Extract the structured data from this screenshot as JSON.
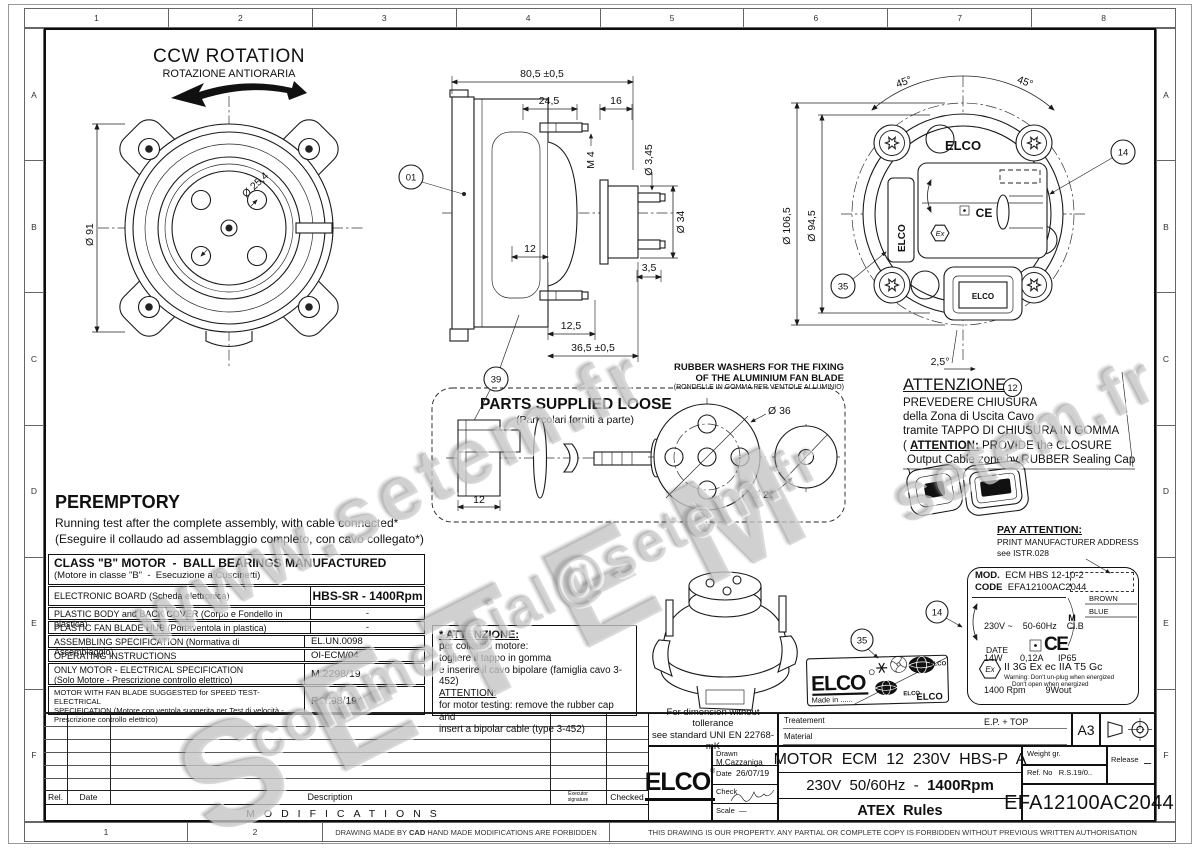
{
  "brand": {
    "name": "ELCO",
    "registered": "®"
  },
  "frame": {
    "cols": [
      "1",
      "2",
      "3",
      "4",
      "5",
      "6",
      "7",
      "8"
    ],
    "rows": [
      "A",
      "B",
      "C",
      "D",
      "E",
      "F"
    ]
  },
  "watermark": {
    "www": "www.setem.fr",
    "setem": "SETEM",
    "email": "commercial@setem.fr",
    "fr": "setem.fr"
  },
  "front_view": {
    "title": "CCW ROTATION",
    "subtitle": "ROTAZIONE ANTIORARIA",
    "dia_body": "Ø 91",
    "dia_shaft": "Ø 25,4"
  },
  "side_view": {
    "len_total": "80,5 ±0,5",
    "len_front": "24,5",
    "len_hub": "16",
    "thread": "M 4",
    "dia_pin": "Ø 3,45",
    "dia_hub": "Ø 34",
    "len_stud": "12",
    "len_pin": "3,5",
    "len_back": "12,5",
    "len_depth": "36,5 ±0,5"
  },
  "rear_view": {
    "dia_outer": "Ø 106,5",
    "dia_bolt": "Ø 94,5",
    "angle_left": "45°",
    "angle_right": "45°",
    "angle_bottom": "2,5°"
  },
  "balloons": {
    "b01": "01",
    "b39": "39",
    "b35": "35",
    "b14": "14",
    "b12": "12"
  },
  "parts_box": {
    "title": "PARTS SUPPLIED LOOSE",
    "subtitle": "(Particolari forniti a parte)",
    "dim_cap": "12",
    "dia_big_washer": "Ø 36",
    "dia_small_washer": "Ø 21",
    "washer_note1": "RUBBER WASHERS FOR THE FIXING",
    "washer_note2": "OF THE ALUMINIUM FAN BLADE",
    "washer_note3": "(RONDELLE IN GOMMA PER VENTOLE ALLUMINIO)"
  },
  "attention_closure": {
    "title": "ATTENZIONE:",
    "line1": "PREVEDERE CHIUSURA",
    "line2": "della Zona di Uscita Cavo",
    "line3": "tramite TAPPO DI CHIUSURA IN GOMMA",
    "line4_pre": "( ",
    "line4_bold": "ATTENTION:",
    "line4_post": " PROVIDE the CLOSURE",
    "line5": "Output Cable zone by RUBBER Sealing Cap )"
  },
  "pay_attention": {
    "title": "PAY ATTENTION:",
    "line1": "PRINT  MANUFACTURER ADDRESS",
    "line2": "see ISTR.028"
  },
  "peremptory": {
    "title": "PEREMPTORY",
    "line1": "Running test after the complete assembly, with cable connected*",
    "line2": "(Eseguire il collaudo ad assemblaggio completo, con cavo collegato*)"
  },
  "class_table": {
    "title": "CLASS \"B\" MOTOR  -  BALL BEARINGS MANUFACTURED",
    "subtitle": "(Motore in classe \"B\"  -  Esecuzione a Cuscinetti)",
    "rows": [
      {
        "l1": "ELECTRONIC BOARD  (Scheda elettronica)",
        "v": "HBS-SR -  1400Rpm"
      },
      {
        "l1": "PLASTIC BODY and BACK COVER  (Corpo e Fondello in plastica)",
        "v": "-"
      },
      {
        "l1": "PLASTIC FAN BLADE HUB  (Portaventola in plastica)",
        "v": "-"
      },
      {
        "l1": "ASSEMBLING SPECIFICATION  (Normativa di Assemblaggio)",
        "v": "EL.UN.0098"
      },
      {
        "l1": "OPERATING INSTRUCTIONS",
        "v": "OI-ECM/04"
      },
      {
        "l1": "ONLY MOTOR - ELECTRICAL SPECIFICATION",
        "l2": "(Solo Motore - Prescrizione controllo elettrico)",
        "v": "M.2298/19"
      },
      {
        "l1": "MOTOR WITH FAN BLADE SUGGESTED for SPEED TEST- ELECTRICAL",
        "l2": "SPECIFICATION   (Motore con ventola suggerita per Test di velocità -",
        "l3": "Prescrizione controllo elettrico)",
        "v": "F.2298/19A"
      }
    ]
  },
  "attention_testing": {
    "title": "* ATTENZIONE:",
    "line1": "per collaudo motore:",
    "line2": "togliere il tappo in gomma",
    "line3": "e inserire il cavo bipolare (famiglia cavo 3-452)",
    "line4": "ATTENTION:",
    "line5": "for motor testing: remove the rubber cap and",
    "line6": "insert a bipolar cable (type 3-452)"
  },
  "elco_label": {
    "made_in": "Made in ......"
  },
  "mod_label": {
    "mod_key": "MOD.",
    "mod_val": "ECM HBS 12-10-2",
    "code_key": "CODE",
    "code_val": "EFA12100AC2044",
    "spec1": "230V ~    50-60Hz    Cl.B",
    "spec2": "14W       0,12A      IP65",
    "spec3": "1400 Rpm        9Wout",
    "spec4": "E.P. + TOP",
    "date": "DATE",
    "ce": "CE",
    "motor_m": "M",
    "motor_ac": "~",
    "wire_brown": "BROWN",
    "wire_blue": "BLUE",
    "ex": "Ex",
    "atex_class": "II 3G Ex ec IIA T5 Gc",
    "warn1": "Warning: Don't un-plug when energized",
    "warn2": "Don't open when energized"
  },
  "title_block": {
    "tol1": "For dimension without tollerance",
    "tol2": "see standard UNI EN 22768-mK",
    "treatment": "Treatement",
    "material": "Material",
    "sheet": "A3",
    "drawn_key": "Drawn",
    "drawn_val": "M.Cazzaniga",
    "date_key": "Date",
    "date_val": "26/07/19",
    "check_key": "Check",
    "scale_key": "Scale",
    "scale_val": "—",
    "title1": "MOTOR  ECM  12  230V  HBS-P  A",
    "title2a": "230V  50/60Hz  -  ",
    "title2b": "1400Rpm",
    "title3": "ATEX  Rules",
    "weight_key": "Weight gr.",
    "ref_key": "Ref. No",
    "ref_val": "R.S.19/0..",
    "release_key": "Release",
    "release_val": "–",
    "code": "EFA12100AC2044"
  },
  "modifications": {
    "rel": "Rel.",
    "date": "Date",
    "desc": "Description",
    "exec1": "Executor",
    "exec2": "signature",
    "checked": "Checked",
    "title": "MODIFICATIONS"
  },
  "footer": {
    "c1": "1",
    "c2": "2",
    "cad_pre": "DRAWING MADE BY ",
    "cad_bold": "CAD",
    "cad_post": " HAND MADE MODIFICATIONS ARE FORBIDDEN",
    "property": "THIS DRAWING IS OUR PROPERTY. ANY PARTIAL OR COMPLETE COPY IS FORBIDDEN WITHOUT PREVIOUS WRITTEN AUTHORISATION"
  }
}
